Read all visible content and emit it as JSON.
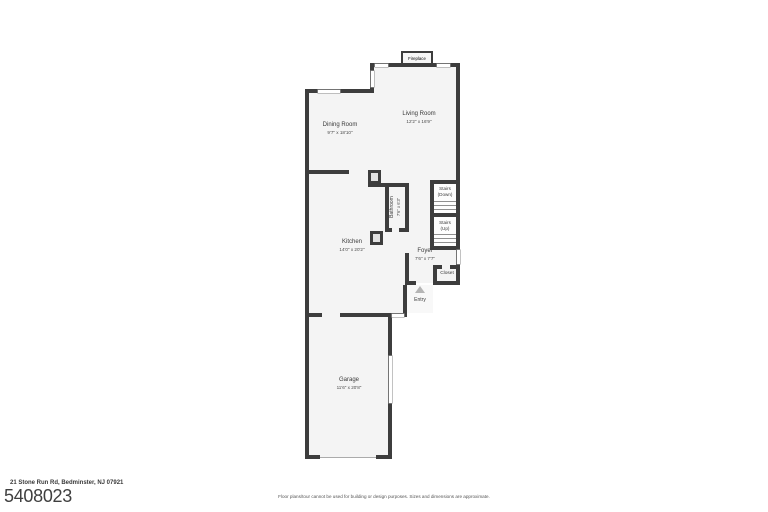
{
  "floor_plan": {
    "rooms": [
      {
        "name": "Living Room",
        "dims": "12'2\" x 16'9\""
      },
      {
        "name": "Dining Room",
        "dims": "9'7\" x 18'10\""
      },
      {
        "name": "Kitchen",
        "dims": "14'0\" x 20'2\""
      },
      {
        "name": "Bathroom",
        "dims": "7'6\" x 6'3\""
      },
      {
        "name": "Foyer",
        "dims": "7'6\" x 7'7\""
      },
      {
        "name": "Garage",
        "dims": "11'6\" x 20'8\""
      }
    ],
    "labels": {
      "fireplace": "Fireplace",
      "stairs_down": [
        "Stairs",
        "(Down)"
      ],
      "stairs_up": [
        "Stairs",
        "(Up)"
      ],
      "closet": "Closet",
      "entry": "Entry"
    },
    "colors": {
      "wall": "#3d3d3d",
      "room_fill": "#f4f4f4",
      "window_outline": "#9a9a9a",
      "entry_arrow": "#b5b5b5"
    }
  },
  "footer": {
    "address": "21 Stone Run Rd, Bedminster, NJ 07921",
    "listing_number": "5408023",
    "disclaimer": "Floor plans/tour cannot be used for building or design purposes. Sizes and dimensions are approximate."
  }
}
